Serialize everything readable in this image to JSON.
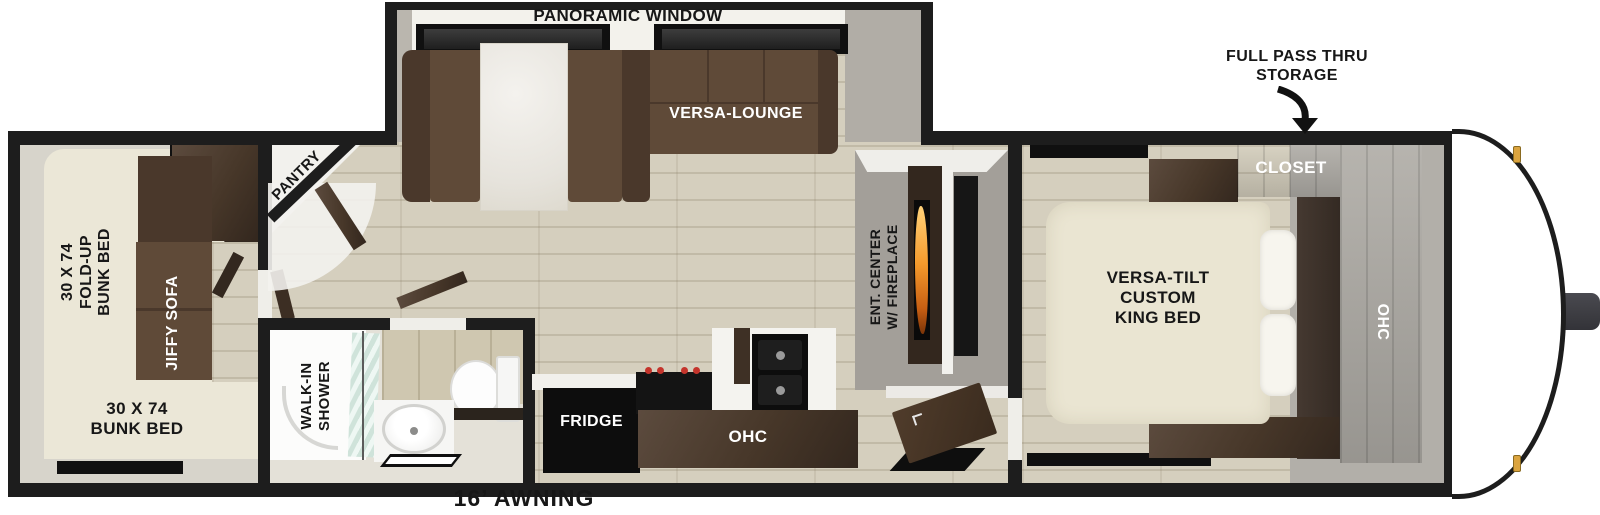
{
  "floorplan": {
    "slideout": {
      "panoramic_window": "PANORAMIC WINDOW",
      "versa_lounge": "VERSA-LOUNGE"
    },
    "exterior": {
      "full_pass_thru_storage": "FULL PASS THRU\nSTORAGE",
      "awning": "16’ AWNING"
    },
    "bedroom": {
      "closet": "CLOSET",
      "ohc": "OHC",
      "king_bed": "VERSA-TILT\nCUSTOM\nKING BED"
    },
    "living": {
      "ent_center": "ENT. CENTER\nW/ FIREPLACE",
      "pantry": "PANTRY"
    },
    "kitchen": {
      "fridge": "FRIDGE",
      "ohc": "OHC"
    },
    "bathroom": {
      "walk_in_shower": "WALK-IN\nSHOWER"
    },
    "bunk_room": {
      "jiffy_sofa": "JIFFY SOFA",
      "fold_up_bunk_bed": "30 X 74\nFOLD-UP\nBUNK BED",
      "bunk_bed": "30 X 74\nBUNK BED"
    }
  },
  "colors": {
    "wall_black": "#1d1d1d",
    "floor_wood": "#d5cfbe",
    "cabinet_brown": "#47372a",
    "sofa_brown": "#5f4a38",
    "bed_cream": "#eae5d2",
    "bunk_platform_cream": "#ebe7d7",
    "ent_wall_gray": "#a39f99",
    "flame_orange": "#ef8f25",
    "marker_light_amber": "#dba43f",
    "shower_glass_frost": "#cfe3da",
    "stove_knob_red": "#c4342b"
  }
}
